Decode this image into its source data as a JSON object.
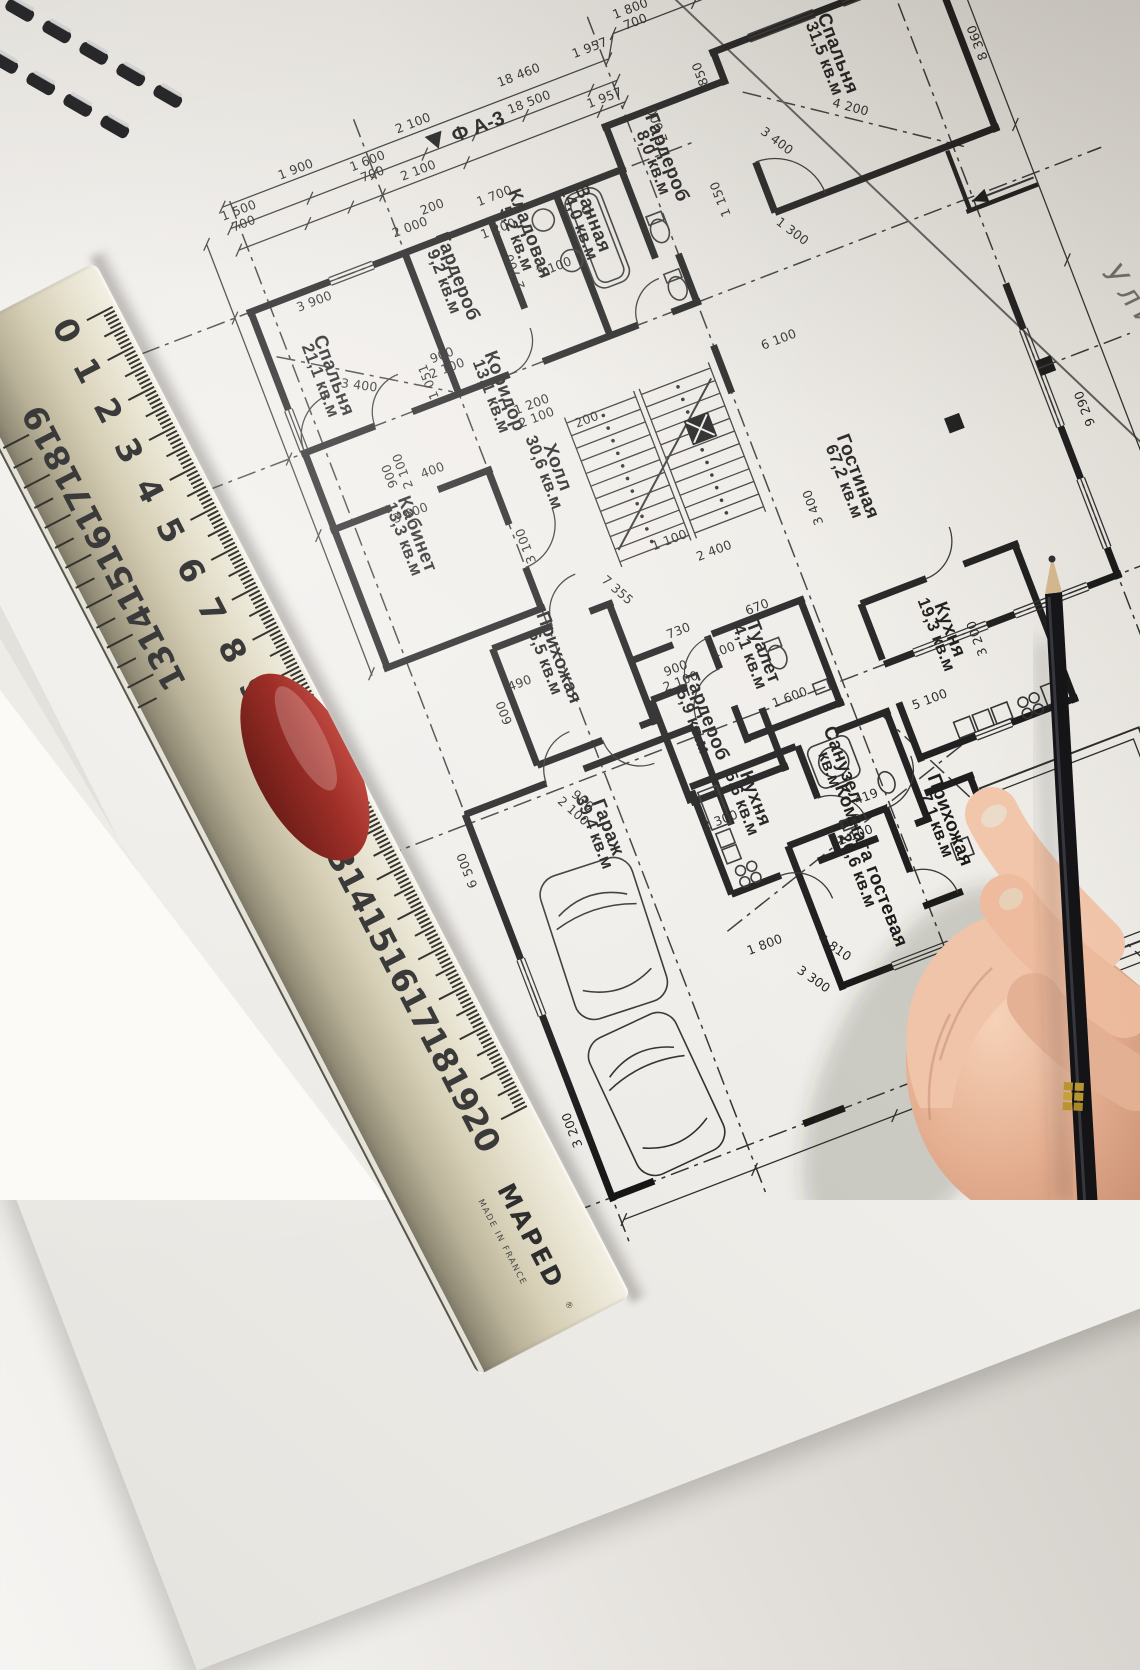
{
  "plan": {
    "marker_icon": "▼",
    "marker": "Ф А-3",
    "street_label": "Улица",
    "area_unit": "кв.м",
    "rooms": [
      {
        "name": "Спальня",
        "area": "21,1 кв.м",
        "x": 586,
        "y": 640
      },
      {
        "name": "Гардероб",
        "area": "9,2 кв.м",
        "x": 737,
        "y": 592
      },
      {
        "name": "Кладовая",
        "area": "5,2 кв.м",
        "x": 820,
        "y": 578
      },
      {
        "name": "Ванная",
        "area": "14,0 кв.м",
        "x": 884,
        "y": 586
      },
      {
        "name": "Гардероб",
        "area": "8,0 кв.м",
        "x": 975,
        "y": 556
      },
      {
        "name": "Спальня",
        "area": "31,5 кв.м",
        "x": 1172,
        "y": 520
      },
      {
        "name": "Коридор",
        "area": "13,1 кв.м",
        "x": 740,
        "y": 716
      },
      {
        "name": "Холл",
        "area": "30,6 кв.м",
        "x": 762,
        "y": 806
      },
      {
        "name": "Кабинет",
        "area": "13,3 кв.м",
        "x": 607,
        "y": 818
      },
      {
        "name": "Гостиная",
        "area": "67,2 кв.м",
        "x": 1039,
        "y": 922
      },
      {
        "name": "Прихожая",
        "area": "6,5 кв.м",
        "x": 695,
        "y": 984
      },
      {
        "name": "Туалет",
        "area": "4,1 кв.м",
        "x": 888,
        "y": 1052
      },
      {
        "name": "Гардероб",
        "area": "5,9 кв.м",
        "x": 812,
        "y": 1092
      },
      {
        "name": "Кухня",
        "area": "19,3 кв.м",
        "x": 1070,
        "y": 1098
      },
      {
        "name": "Гараж",
        "area": "39,4 кв.м",
        "x": 680,
        "y": 1160
      },
      {
        "name": "Кухня",
        "area": "5,6 кв.м",
        "x": 828,
        "y": 1186
      },
      {
        "name": "Санузел",
        "area": "кв.м",
        "x": 922,
        "y": 1186
      },
      {
        "name": "Комната гостевая",
        "area": "20,6 кв.м",
        "x": 912,
        "y": 1290
      },
      {
        "name": "Прихожая",
        "area": "7,1 кв.м",
        "x": 1002,
        "y": 1276
      }
    ],
    "dimensions": [
      {
        "t": "18 460",
        "x": 872,
        "y": 430,
        "r": 0
      },
      {
        "t": "18 500",
        "x": 872,
        "y": 459,
        "r": 0
      },
      {
        "t": "1 957",
        "x": 948,
        "y": 430,
        "r": 0
      },
      {
        "t": "1 957",
        "x": 944,
        "y": 482,
        "r": 0
      },
      {
        "t": "1 900",
        "x": 630,
        "y": 438,
        "r": 0
      },
      {
        "t": "1 500",
        "s": "700",
        "x": 562,
        "y": 456,
        "r": 0
      },
      {
        "t": "2 100",
        "x": 756,
        "y": 437,
        "r": 0
      },
      {
        "t": "2 100",
        "x": 744,
        "y": 483,
        "r": 0
      },
      {
        "t": "1 600",
        "s": "700",
        "x": 700,
        "y": 456,
        "r": 0
      },
      {
        "t": "1 800",
        "s": "700",
        "x": 1000,
        "y": 408,
        "r": 0
      },
      {
        "t": "2 000",
        "x": 716,
        "y": 533,
        "r": 0
      },
      {
        "t": "8 360",
        "x": 1316,
        "y": 560,
        "r": -90
      },
      {
        "t": "4 200",
        "x": 1168,
        "y": 578,
        "r": 36
      },
      {
        "t": "6 100",
        "x": 1020,
        "y": 770,
        "r": 0
      },
      {
        "t": "3 400",
        "x": 996,
        "y": 935,
        "r": -90
      },
      {
        "t": "9 290",
        "x": 1285,
        "y": 940,
        "r": -90
      },
      {
        "t": "3 900",
        "x": 600,
        "y": 568,
        "r": 0
      },
      {
        "t": "3 400",
        "x": 610,
        "y": 662,
        "r": 28
      },
      {
        "t": "3 600",
        "x": 614,
        "y": 800,
        "r": 0
      },
      {
        "t": "3 100",
        "x": 836,
        "y": 622,
        "r": 0
      },
      {
        "t": "3 100",
        "x": 714,
        "y": 868,
        "r": -90
      },
      {
        "t": "7 355",
        "x": 776,
        "y": 944,
        "r": 62
      },
      {
        "t": "2 400",
        "x": 884,
        "y": 944,
        "r": 0
      },
      {
        "t": "1 100",
        "x": 846,
        "y": 918,
        "r": 0
      },
      {
        "t": "200",
        "x": 812,
        "y": 776,
        "r": 0
      },
      {
        "t": "5 100",
        "x": 1032,
        "y": 1160,
        "r": 0
      },
      {
        "t": "3 200",
        "x": 1102,
        "y": 1116,
        "r": -90
      },
      {
        "t": "6 500",
        "x": 543,
        "y": 1150,
        "r": -90
      },
      {
        "t": "900",
        "s": "2 100",
        "x": 700,
        "y": 664,
        "r": 0
      },
      {
        "t": "900",
        "s": "2 100",
        "x": 612,
        "y": 754,
        "r": -90
      },
      {
        "t": "900",
        "s": "2 100",
        "x": 806,
        "y": 1040,
        "r": 0
      },
      {
        "t": "900",
        "s": "2 100",
        "x": 668,
        "y": 1128,
        "r": 62
      },
      {
        "t": "800",
        "s": "2 100",
        "x": 914,
        "y": 1246,
        "r": 0
      },
      {
        "t": "1 200",
        "s": "2 100",
        "x": 766,
        "y": 742,
        "r": 0
      },
      {
        "t": "2 300",
        "x": 793,
        "y": 1198,
        "r": 0
      },
      {
        "t": "1 600",
        "x": 902,
        "y": 1108,
        "r": 0
      },
      {
        "t": "730",
        "x": 822,
        "y": 1006,
        "r": 0
      },
      {
        "t": "670",
        "x": 904,
        "y": 1012,
        "r": 0
      },
      {
        "t": "490",
        "x": 655,
        "y": 998,
        "r": 0
      },
      {
        "t": "4 810",
        "x": 851,
        "y": 1356,
        "r": 56
      },
      {
        "t": "4 000",
        "x": 1010,
        "y": 1490,
        "r": 18
      },
      {
        "t": "3 300",
        "x": 820,
        "y": 1378,
        "r": 56
      },
      {
        "t": "1 800",
        "x": 790,
        "y": 1330,
        "r": 0
      },
      {
        "t": "3 200",
        "x": 548,
        "y": 1430,
        "r": -90
      },
      {
        "t": "419",
        "x": 938,
        "y": 1228,
        "r": 0
      },
      {
        "t": "1 051",
        "x": 682,
        "y": 680,
        "r": -90
      },
      {
        "t": "850",
        "x": 1046,
        "y": 490,
        "r": -90
      },
      {
        "t": "2 000",
        "x": 988,
        "y": 522,
        "r": -90
      },
      {
        "t": "1 300",
        "x": 1068,
        "y": 672,
        "r": 58
      },
      {
        "t": "1 150",
        "x": 1020,
        "y": 614,
        "r": -90
      },
      {
        "t": "3 400",
        "x": 1086,
        "y": 582,
        "r": 58
      },
      {
        "t": "2 700",
        "x": 802,
        "y": 608,
        "r": -90
      },
      {
        "t": "1 700",
        "x": 806,
        "y": 534,
        "r": 0
      },
      {
        "t": "1 200",
        "x": 798,
        "y": 566,
        "r": 0
      },
      {
        "t": "200",
        "x": 744,
        "y": 522,
        "r": 0
      },
      {
        "t": "600",
        "x": 634,
        "y": 1016,
        "r": -90
      },
      {
        "t": "400",
        "x": 650,
        "y": 768,
        "r": 0
      },
      {
        "t": "100",
        "x": 857,
        "y": 1040,
        "r": 0
      }
    ]
  },
  "ruler": {
    "brand": "MAPED",
    "reg": "®",
    "made_in": "MADE IN FRANCE",
    "numbers": [
      0,
      1,
      2,
      3,
      4,
      5,
      6,
      7,
      8,
      9,
      10,
      11,
      12,
      13,
      14,
      15,
      16,
      17,
      18,
      19,
      20
    ],
    "reverse_numbers": [
      19,
      18,
      17,
      16,
      15,
      14,
      13
    ],
    "handle_color": "#9f2f28",
    "face_color": "#d6cfb6"
  },
  "pencil": {
    "body_color": "#141417",
    "logo_color": "#b8952e"
  },
  "colors": {
    "ink": "#161616",
    "paper": "#eeece7",
    "desk": "#e9e7e3"
  }
}
